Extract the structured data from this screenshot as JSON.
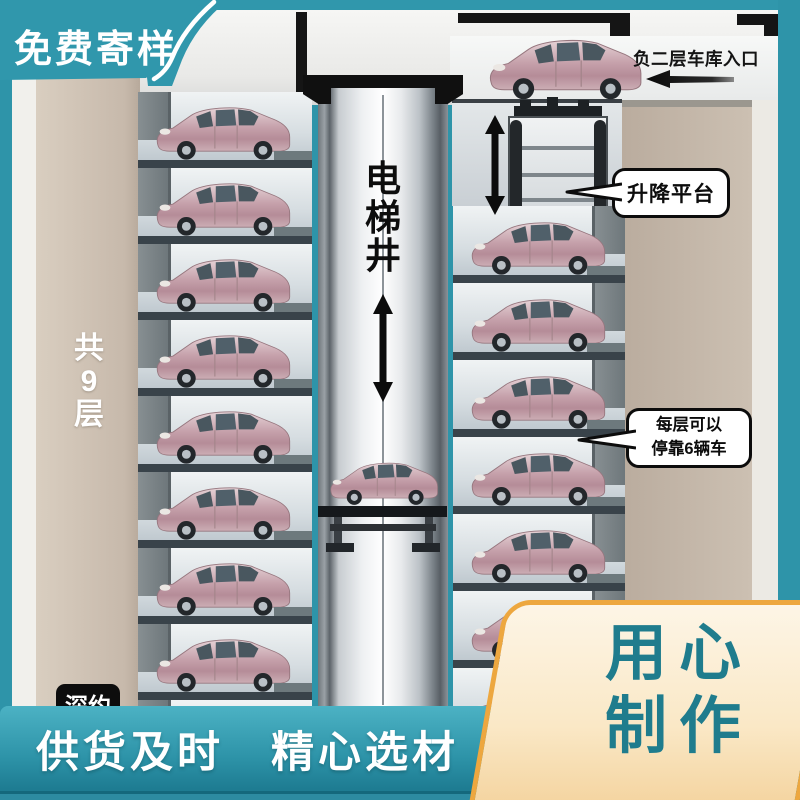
{
  "promo": {
    "top_left_banner": "免费寄样",
    "bottom_banner": "供货及时　精心选材",
    "craft_line1": "用心",
    "craft_line2": "制作",
    "partial_badge": "深约"
  },
  "diagram": {
    "entrance_label": "负二层车库入口",
    "lift_platform_label": "升降平台",
    "shaft_label": "电梯井",
    "floors_label": "共9层",
    "capacity_line1": "每层可以",
    "capacity_line2": "停靠6辆车",
    "left_levels": 9,
    "right_levels": 7
  },
  "colors": {
    "teal": "#2e94a9",
    "teal_dark": "#14687c",
    "craft_border": "#eda73f",
    "craft_text": "#1f7c8d",
    "beige_wall": "#cabdaf"
  }
}
